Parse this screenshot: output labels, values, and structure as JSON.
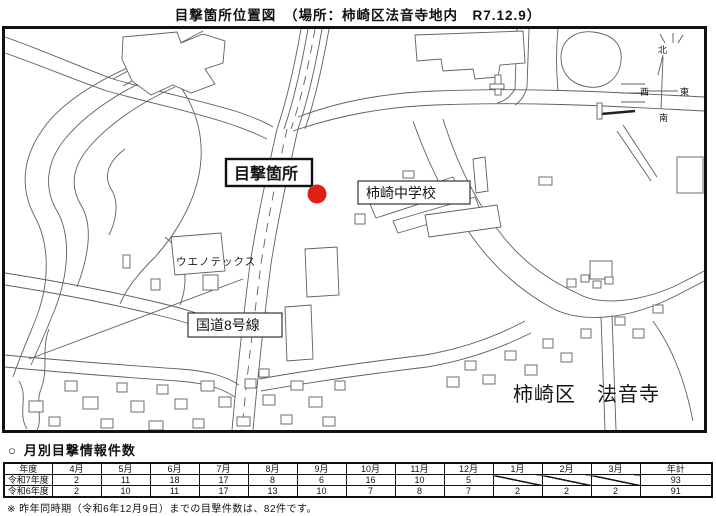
{
  "title": "目撃箇所位置図　（場所：柿崎区法音寺地内　R7.12.9）",
  "map": {
    "labels": {
      "sighting": "目撃箇所",
      "school": "柿崎中学校",
      "uenotex": "ウエノテックス",
      "route8": "国道8号線",
      "district": "柿崎区　法音寺"
    },
    "compass": {
      "north": "北",
      "south": "南",
      "east": "東",
      "west": "西"
    },
    "marker_color": "#dd2018"
  },
  "section": {
    "bullet": "○",
    "heading": "月別目撃情報件数"
  },
  "table": {
    "columns": [
      "年度",
      "4月",
      "5月",
      "6月",
      "7月",
      "8月",
      "9月",
      "10月",
      "11月",
      "12月",
      "1月",
      "2月",
      "3月",
      "年計"
    ],
    "rows": [
      {
        "label": "令和7年度",
        "values": [
          "2",
          "11",
          "18",
          "17",
          "8",
          "6",
          "16",
          "10",
          "5",
          "",
          "",
          "",
          "93"
        ]
      },
      {
        "label": "令和6年度",
        "values": [
          "2",
          "10",
          "11",
          "17",
          "13",
          "10",
          "7",
          "8",
          "7",
          "2",
          "2",
          "2",
          "91"
        ]
      }
    ]
  },
  "footnote": "※ 昨年同時期（令和6年12月9日）までの目撃件数は、82件です。"
}
